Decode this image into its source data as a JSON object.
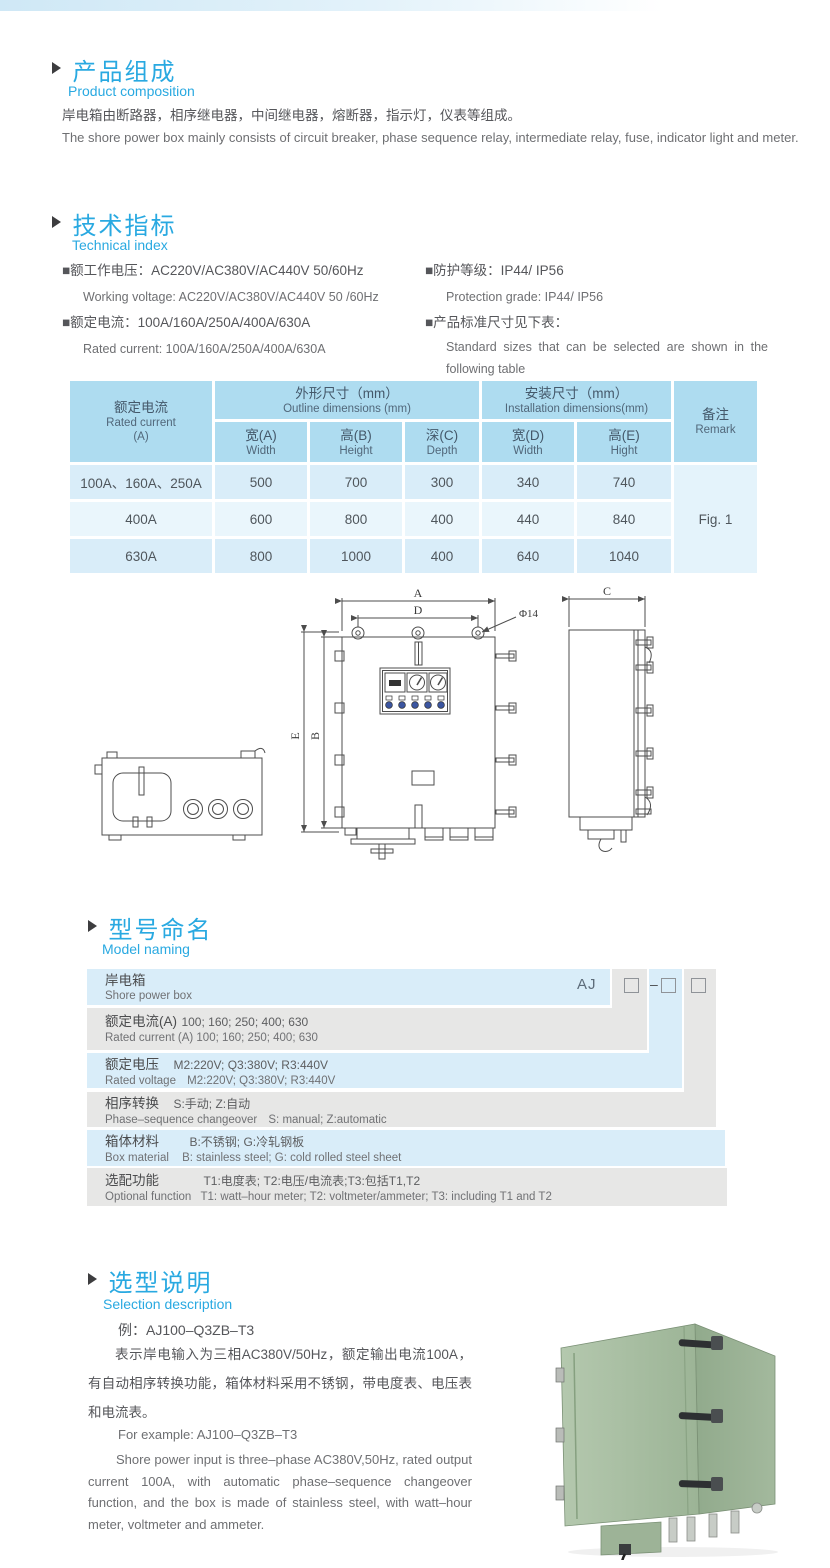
{
  "product_composition": {
    "title_cn": "产品组成",
    "title_en": "Product  composition",
    "desc_cn": "岸电箱由断路器，相序继电器，中间继电器，熔断器，指示灯，仪表等组成。",
    "desc_en": "The shore power box mainly consists of circuit breaker, phase sequence relay, intermediate relay, fuse, indicator light and meter."
  },
  "technical_index": {
    "title_cn": "技术指标",
    "title_en": "Technical index",
    "specs_left": [
      {
        "cn": "■额工作电压：AC220V/AC380V/AC440V  50/60Hz",
        "en": "Working voltage: AC220V/AC380V/AC440V 50 /60Hz"
      },
      {
        "cn": "■额定电流：100A/160A/250A/400A/630A",
        "en": "Rated current: 100A/160A/250A/400A/630A"
      }
    ],
    "specs_right": [
      {
        "cn": "■防护等级：IP44/ IP56",
        "en": "Protection grade: IP44/ IP56"
      },
      {
        "cn": "■产品标准尺寸见下表：",
        "en": "Standard sizes that can be selected are shown in the following table"
      }
    ]
  },
  "dimensions_table": {
    "header": {
      "rated_current": {
        "cn": "额定电流",
        "en": "Rated current",
        "unit": "(A)"
      },
      "outline": {
        "cn": "外形尺寸（mm）",
        "en": "Outline dimensions (mm)"
      },
      "installation": {
        "cn": "安装尺寸（mm）",
        "en": "Installation dimensions(mm)"
      },
      "remark": {
        "cn": "备注",
        "en": "Remark"
      },
      "sub": [
        {
          "cn": "宽(A)",
          "en": "Width"
        },
        {
          "cn": "高(B)",
          "en": "Height"
        },
        {
          "cn": "深(C)",
          "en": "Depth"
        },
        {
          "cn": "宽(D)",
          "en": "Width"
        },
        {
          "cn": "高(E)",
          "en": "Hight"
        }
      ]
    },
    "rows": [
      {
        "current": "100A、160A、250A",
        "values": [
          "500",
          "700",
          "300",
          "340",
          "740"
        ]
      },
      {
        "current": "400A",
        "values": [
          "600",
          "800",
          "400",
          "440",
          "840"
        ]
      },
      {
        "current": "630A",
        "values": [
          "800",
          "1000",
          "400",
          "640",
          "1040"
        ]
      }
    ],
    "remark_value": "Fig. 1"
  },
  "drawing": {
    "labels": {
      "a": "A",
      "d": "D",
      "b": "B",
      "e": "E",
      "c": "C",
      "hole": "Φ14"
    }
  },
  "model_naming": {
    "title_cn": "型号命名",
    "title_en": "Model naming",
    "prefix": "AJ",
    "dash": "–",
    "rows": [
      {
        "label_cn": "岸电箱",
        "value_cn": "",
        "label_en": "Shore power box",
        "value_en": ""
      },
      {
        "label_cn": "额定电流(A)",
        "value_cn": "100; 160; 250; 400; 630",
        "label_en": "Rated current (A)",
        "value_en": "100; 160; 250; 400; 630"
      },
      {
        "label_cn": "额定电压",
        "value_cn": "M2:220V;  Q3:380V;  R3:440V",
        "label_en": "Rated voltage",
        "value_en": "M2:220V;  Q3:380V;  R3:440V"
      },
      {
        "label_cn": "相序转换",
        "value_cn": "S:手动; Z:自动",
        "label_en": "Phase–sequence changeover",
        "value_en": "S: manual;  Z:automatic"
      },
      {
        "label_cn": "箱体材料",
        "value_cn": "B:不锈钢;  G:冷轧钢板",
        "label_en": "Box material",
        "value_en": "B: stainless steel; G: cold rolled steel sheet"
      },
      {
        "label_cn": "选配功能",
        "value_cn": "T1:电度表;  T2:电压/电流表;T3:包括T1,T2",
        "label_en": "Optional function",
        "value_en": "T1: watt–hour meter; T2: voltmeter/ammeter; T3: including T1 and T2"
      }
    ]
  },
  "selection": {
    "title_cn": "选型说明",
    "title_en": "Selection description",
    "example_cn": "例：AJ100–Q3ZB–T3",
    "desc_cn": "表示岸电输入为三相AC380V/50Hz，额定输出电流100A，有自动相序转换功能，箱体材料采用不锈钢，带电度表、电压表和电流表。",
    "example_en": "For example: AJ100–Q3ZB–T3",
    "desc_en": "Shore power input is three–phase AC380V,50Hz, rated output current 100A, with automatic phase–sequence changeover function, and the box is made of stainless steel, with watt–hour meter, voltmeter and ammeter."
  }
}
